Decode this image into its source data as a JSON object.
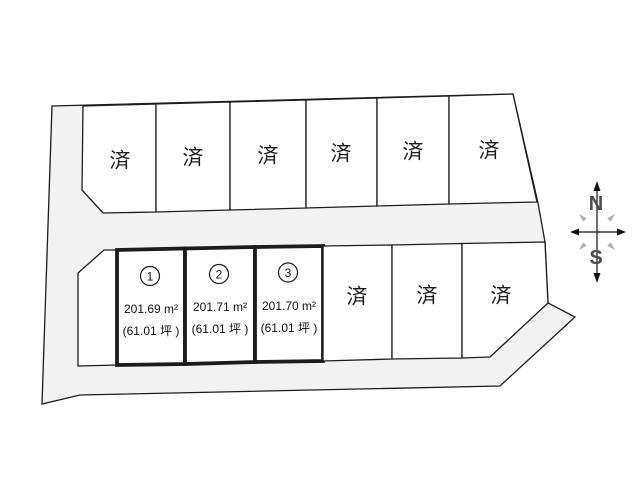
{
  "diagram": {
    "type": "land-lot-layout",
    "top_row_sold": [
      "済",
      "済",
      "済",
      "済",
      "済",
      "済"
    ],
    "bottom_row_sold": [
      "済",
      "済",
      "済"
    ],
    "numbered_lots": [
      {
        "number": "1",
        "area_m2": "201.69 m²",
        "area_tsubo": "(61.01 坪 )"
      },
      {
        "number": "2",
        "area_m2": "201.71 m²",
        "area_tsubo": "(61.01 坪 )"
      },
      {
        "number": "3",
        "area_m2": "201.70 m²",
        "area_tsubo": "(61.01 坪 )"
      }
    ],
    "compass": {
      "north": "N",
      "south": "S"
    },
    "colors": {
      "road": "#f2f2f2",
      "lot": "#ffffff",
      "line": "#1c1c1c",
      "compass_letter": "#4c4c4c",
      "compass_tick": "#b2b2b2"
    }
  }
}
